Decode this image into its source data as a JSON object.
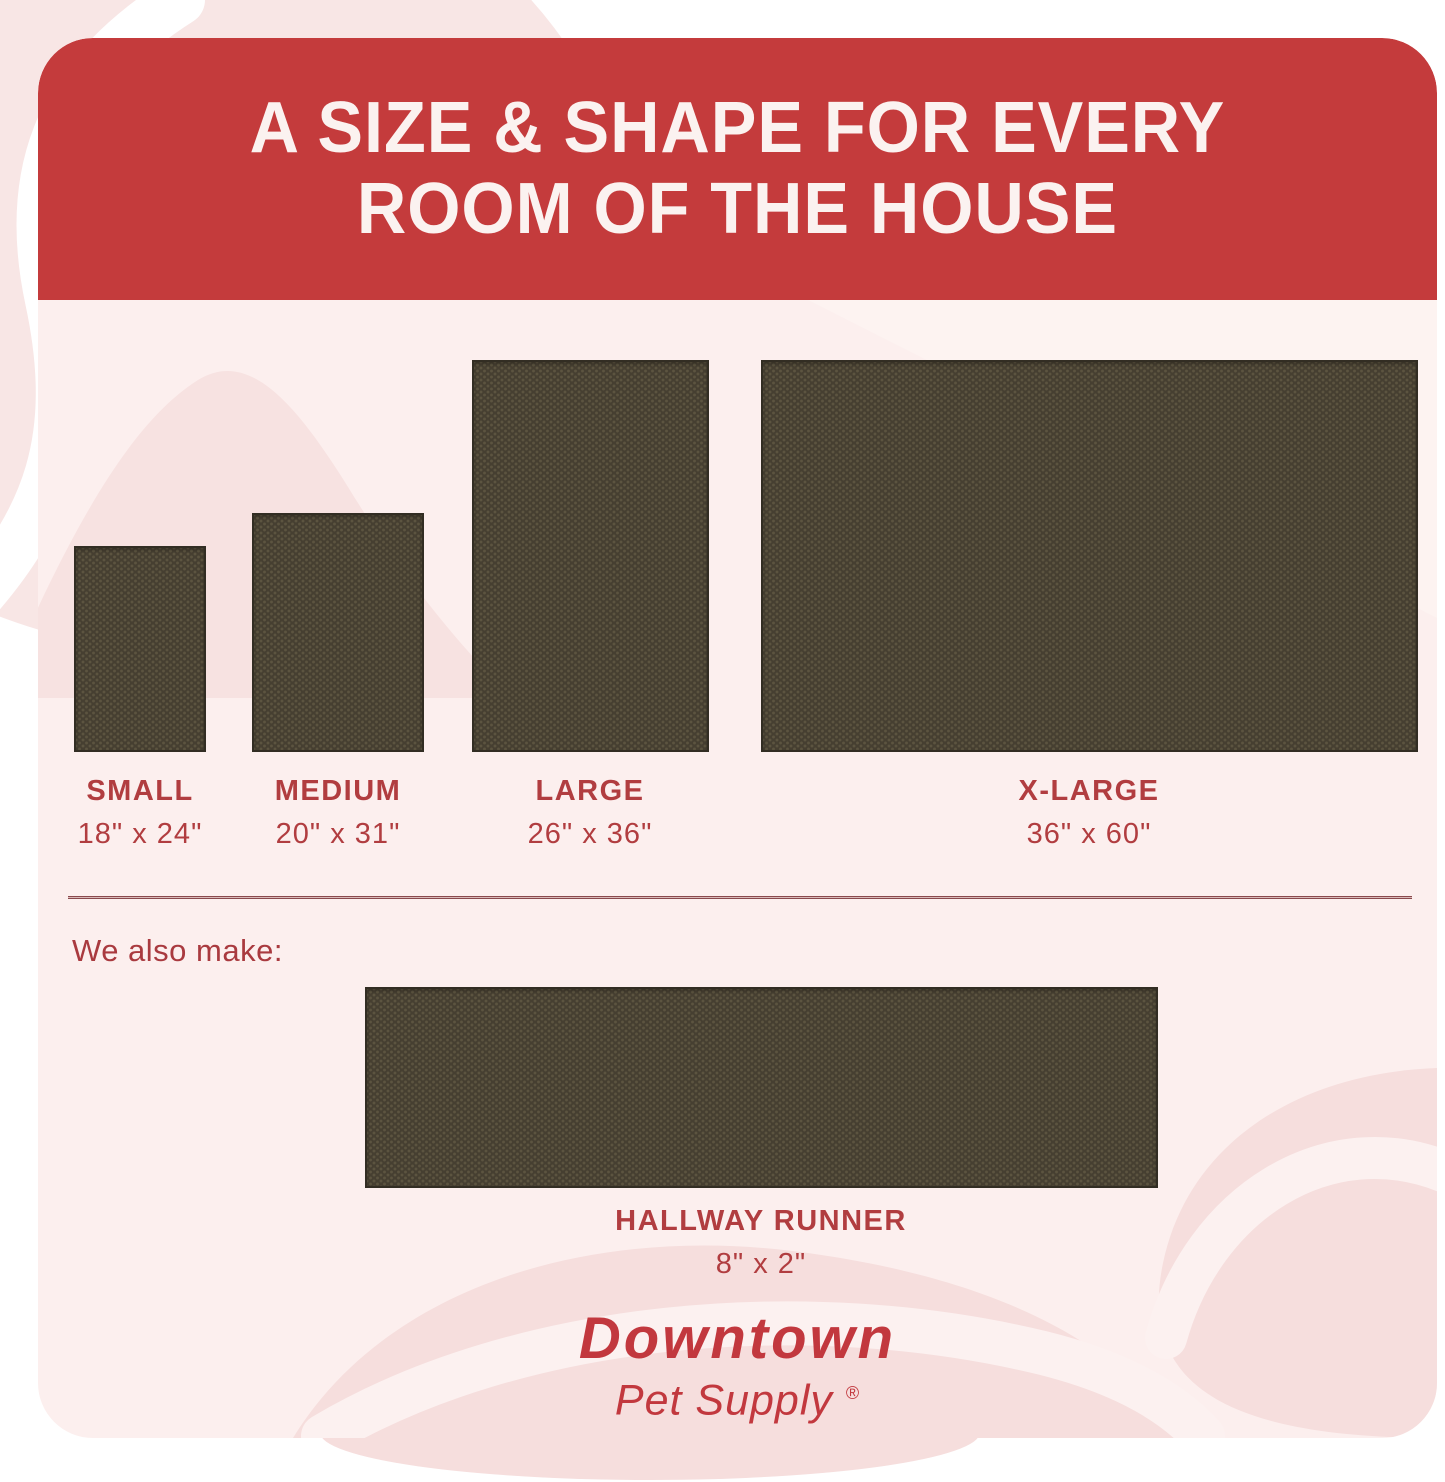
{
  "header": {
    "title_line1": "A SIZE & SHAPE FOR EVERY",
    "title_line2": "ROOM OF THE HOUSE"
  },
  "sizes": [
    {
      "name": "SMALL",
      "dimensions": "18\" x 24\""
    },
    {
      "name": "MEDIUM",
      "dimensions": "20\" x 31\""
    },
    {
      "name": "LARGE",
      "dimensions": "26\" x 36\""
    },
    {
      "name": "X-LARGE",
      "dimensions": "36\" x 60\""
    }
  ],
  "also_make": {
    "label": "We also make:",
    "item_name": "HALLWAY RUNNER",
    "item_dimensions": "8\" x 2\""
  },
  "brand": {
    "name": "Downtown",
    "tagline": "Pet Supply",
    "registered_mark": "®"
  },
  "colors": {
    "banner_red": "#c43b3c",
    "title_text": "#fbf2f0",
    "label_red": "#b13d40",
    "logo_red": "#c2383e",
    "card_pink": "#fcefee",
    "outer_blob_pink": "#f8e6e5",
    "swirl_pink": "#f6dedd",
    "mat_brown": "#463f31",
    "mat_dot_brown": "#5c5440",
    "divider_maroon": "#8a494d"
  }
}
